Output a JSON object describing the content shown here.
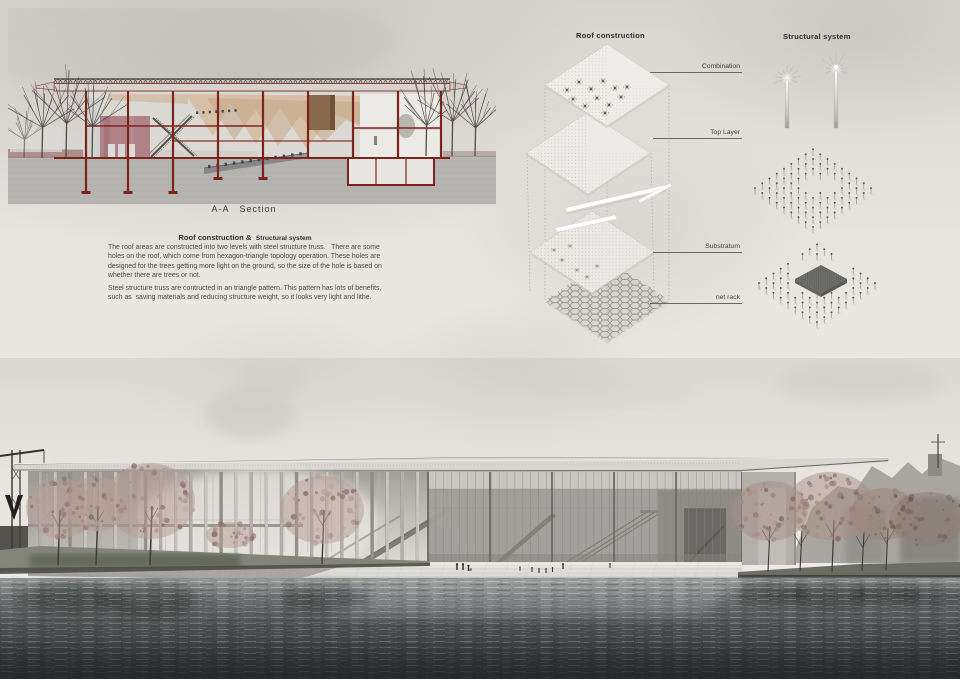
{
  "section": {
    "caption": "A-A   Section"
  },
  "text_block": {
    "heading_main": "Roof construction &",
    "heading_sub": "Structural system",
    "paragraph1": "The roof areas are constructed into two levels with steel structure truss.   There are some holes on the roof, which come from hexagon-triangle topology operation. These holes are designed for the trees getting more light on the ground, so the size of the hole is based on whether there are trees or not.",
    "paragraph2": "Steel structure truss are contructed in an triangle pattern. This pattern has lots of benefits, such as  saving materials and reducing structure weight, so it looks very light and lithe."
  },
  "roof_construction": {
    "title": "Roof construction",
    "layers": [
      {
        "label": "Combination"
      },
      {
        "label": "Top Layer"
      },
      {
        "label": "Substratum"
      },
      {
        "label": "net rack"
      }
    ]
  },
  "structural_system": {
    "title": "Structural system"
  },
  "colors": {
    "board_background": "#e8e5e0",
    "section_frame_red": "#7c241a",
    "text": "#45433f",
    "water_dark": "#333638",
    "foliage": "#b0978f",
    "roof_slab": "#d9d6d1",
    "net_rack_mesh": "#8e8a83"
  }
}
